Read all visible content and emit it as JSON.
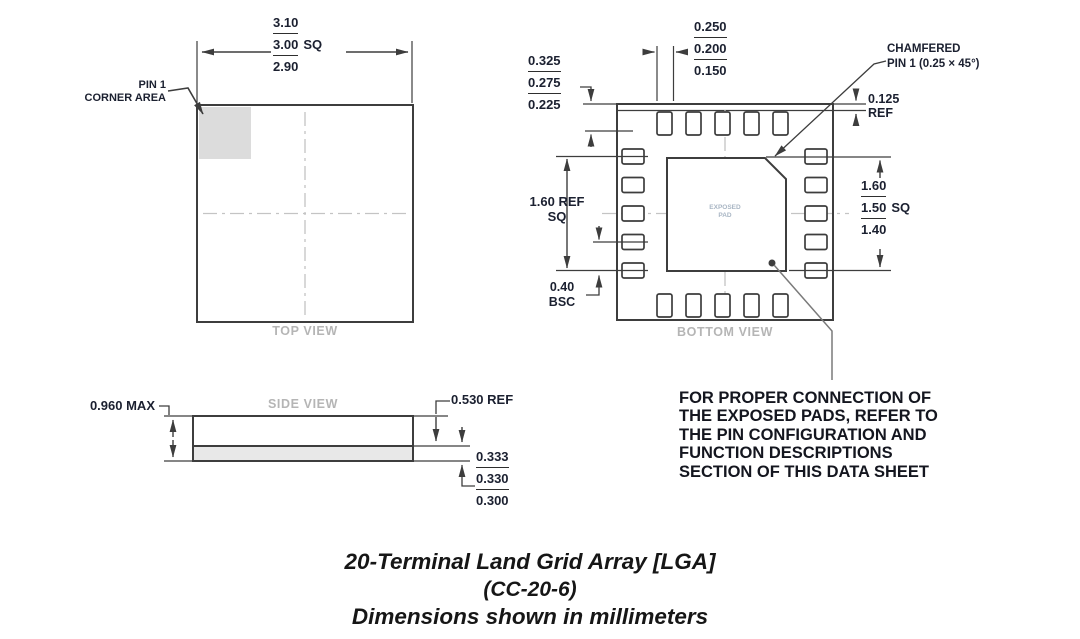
{
  "top_view": {
    "label": "TOP VIEW",
    "width_dim": {
      "max": "3.10",
      "nom": "3.00",
      "nom_suffix": "SQ",
      "min": "2.90"
    },
    "pin1_label": {
      "line1": "PIN 1",
      "line2": "CORNER AREA"
    }
  },
  "bottom_view": {
    "label": "BOTTOM VIEW",
    "pad_width_dim": {
      "max": "0.250",
      "nom": "0.200",
      "min": "0.150"
    },
    "edge_to_pad_dim": {
      "max": "0.325",
      "nom": "0.275",
      "min": "0.225"
    },
    "chamfer_note": {
      "line1": "CHAMFERED",
      "line2": "PIN 1 (0.25 × 45°)"
    },
    "rim_dim": {
      "value": "0.125",
      "suffix": "REF"
    },
    "pad_span_dim": {
      "value": "1.60 REF",
      "suffix": "SQ"
    },
    "pitch_dim": {
      "value": "0.40",
      "suffix": "BSC"
    },
    "exposed_pad_dim": {
      "max": "1.60",
      "nom": "1.50",
      "nom_suffix": "SQ",
      "min": "1.40"
    },
    "exposed_pad_label": {
      "line1": "EXPOSED",
      "line2": "PAD"
    }
  },
  "side_view": {
    "label": "SIDE VIEW",
    "height_dim": "0.960 MAX",
    "body_dim": "0.530 REF",
    "pad_height_dim": {
      "max": "0.333",
      "nom": "0.330",
      "min": "0.300"
    }
  },
  "note": {
    "text": "FOR PROPER CONNECTION OF\nTHE EXPOSED PADS, REFER TO\nTHE PIN CONFIGURATION AND\nFUNCTION DESCRIPTIONS\nSECTION OF THIS DATA SHEET"
  },
  "caption": {
    "line1": "20-Terminal Land Grid Array [LGA]",
    "line2": "(CC-20-6)",
    "line3": "Dimensions shown in millimeters"
  }
}
